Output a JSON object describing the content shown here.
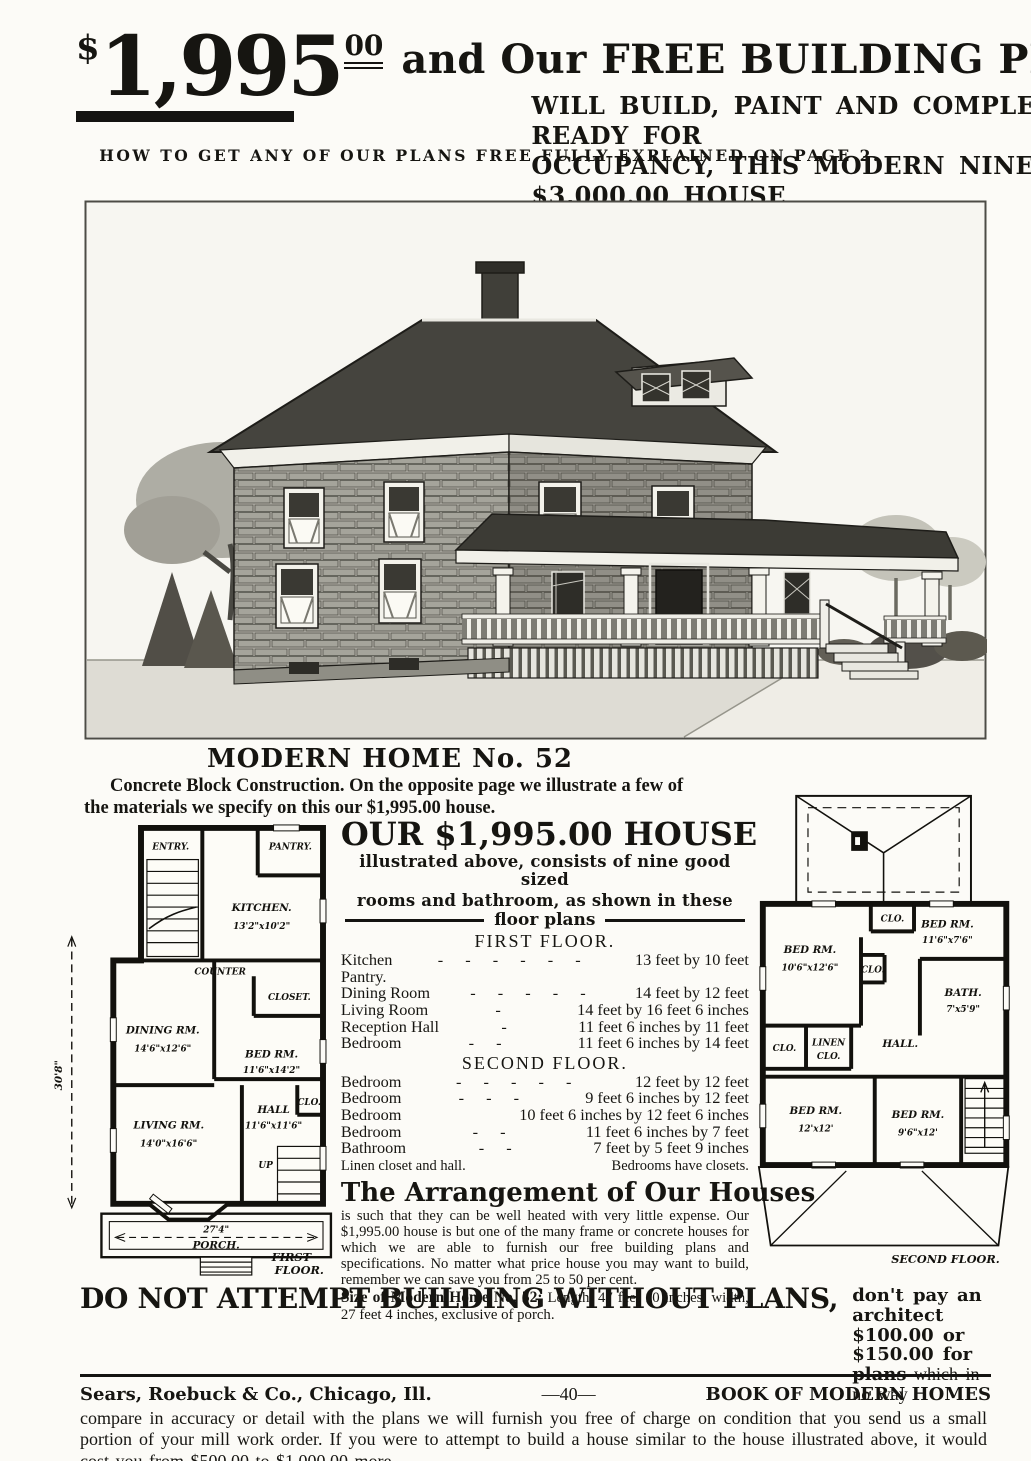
{
  "colors": {
    "ink": "#161511",
    "paper": "#fcfbf7"
  },
  "header": {
    "dollar": "$",
    "amount": "1,995",
    "cents": "00",
    "tagline": "and Our FREE BUILDING PLANS",
    "sub1": "WILL BUILD, PAINT AND COMPLETE, READY FOR",
    "sub2": "OCCUPANCY, THIS MODERN NINE-ROOM $3,000.00 HOUSE",
    "note": "HOW TO GET ANY OF OUR PLANS FREE FULLY EXPLAINED ON PAGE 2."
  },
  "modern_home": {
    "heading": "MODERN HOME No. 52",
    "intro1": "Concrete Block Construction.   On the opposite page we illustrate a few of",
    "intro2": "the materials we specify on this our $1,995.00 house."
  },
  "offer": {
    "heading": "OUR $1,995.00 HOUSE",
    "sub1": "illustrated above, consists of nine good sized",
    "sub2": "rooms and bathroom, as shown in these",
    "rule_label": "floor plans",
    "first_floor_heading": "FIRST FLOOR.",
    "ff_rooms": [
      {
        "name": "Kitchen",
        "leader": "-  -  -  -  -  -",
        "dims": "13 feet by 10 feet"
      },
      {
        "name": "Pantry.",
        "leader": "",
        "dims": ""
      },
      {
        "name": "Dining Room",
        "leader": "-  -  -  -  -",
        "dims": "14 feet by 12 feet"
      },
      {
        "name": "Living Room",
        "leader": "-",
        "dims": "14 feet by 16 feet 6 inches"
      },
      {
        "name": "Reception Hall",
        "leader": "-",
        "dims": "11 feet 6 inches by 11 feet"
      },
      {
        "name": "Bedroom",
        "leader": "-  -",
        "dims": "11 feet 6 inches by 14 feet"
      }
    ],
    "second_floor_heading": "SECOND FLOOR.",
    "sf_rooms": [
      {
        "name": "Bedroom",
        "leader": "-  -  -  -  -",
        "dims": "12 feet by 12 feet"
      },
      {
        "name": "Bedroom",
        "leader": "-  -  -",
        "dims": "9 feet 6 inches by 12 feet"
      },
      {
        "name": "Bedroom",
        "leader": "",
        "dims": "10 feet 6 inches by 12 feet 6 inches"
      },
      {
        "name": "Bedroom",
        "leader": "-  -",
        "dims": "11 feet 6 inches by 7 feet"
      },
      {
        "name": "Bathroom",
        "leader": "-  -",
        "dims": "7 feet by 5 feet 9 inches"
      }
    ],
    "note_left": "Linen closet and hall.",
    "note_right": "Bedrooms have closets."
  },
  "arrangement": {
    "heading": "The Arrangement of Our Houses",
    "body": "is such that they can be well heated with very little expense.  Our $1,995.00 house is but one of the many frame or concrete houses for which we are able to furnish our free building plans and specifications.  No matter what price house you may want to build, remember we can save you from 25 to 50 per cent.",
    "size_label": "Size of Modern Home No. 52:",
    "size_text": "Length, 47 feet 10 inches; width, 27 feet 4 inches, exclusive of porch."
  },
  "warning": {
    "heading": "DO NOT ATTEMPT BUILDING WITHOUT PLANS,",
    "aside_bold1": "don't pay an architect $100.00 or",
    "aside_bold2": "$150.00 for plans",
    "aside_reg2": "which in no way",
    "body": "compare in accuracy or detail with the plans we will furnish you free of charge on condition that you send us a small portion of your mill work order.   If you were to attempt to build a house similar to the house illustrated above, it would cost you from $500.00 to $1,000.00 more.",
    "see_line": "See how you can get the plans for this house free on page 2."
  },
  "footer": {
    "left": "Sears, Roebuck & Co., Chicago, Ill.",
    "center": "—40—",
    "right": "BOOK OF MODERN HOMES"
  },
  "plans": {
    "first_floor": {
      "dim_height": "30'8\"",
      "entry": "ENTRY.",
      "pantry": "PANTRY.",
      "kitchen": "KITCHEN.",
      "kitchen_dims": "13'2\"x10'2\"",
      "counter": "COUNTER",
      "closet": "CLOSET.",
      "dining": "DINING RM.",
      "dining_dims": "14'6\"x12'6\"",
      "bed": "BED RM.",
      "bed_dims": "11'6\"x14'2\"",
      "living": "LIVING RM.",
      "living_dims": "14'0\"x16'6\"",
      "hall": "HALL",
      "hall_dims": "11'6\"x11'6\"",
      "clo": "CLO.",
      "up": "UP",
      "porch_dim": "27'4\"",
      "porch": "PORCH.",
      "caption1": "FIRST",
      "caption2": "FLOOR."
    },
    "second_floor": {
      "clo_top": "CLO.",
      "bed_tl": "BED RM.",
      "bed_tl_dims": "10'6\"x12'6\"",
      "bed_tr": "BED RM.",
      "bed_tr_dims": "11'6\"x7'6\"",
      "clo_mid": "CLO.",
      "bath": "BATH.",
      "bath_dims": "7'x5'9\"",
      "clo_left": "CLO.",
      "linen1": "LINEN",
      "linen2": "CLO.",
      "hall": "HALL.",
      "bed_bl": "BED RM.",
      "bed_bl_dims": "12'x12'",
      "bed_bm": "BED RM.",
      "bed_bm_dims": "9'6\"x12'",
      "caption": "SECOND FLOOR."
    }
  }
}
